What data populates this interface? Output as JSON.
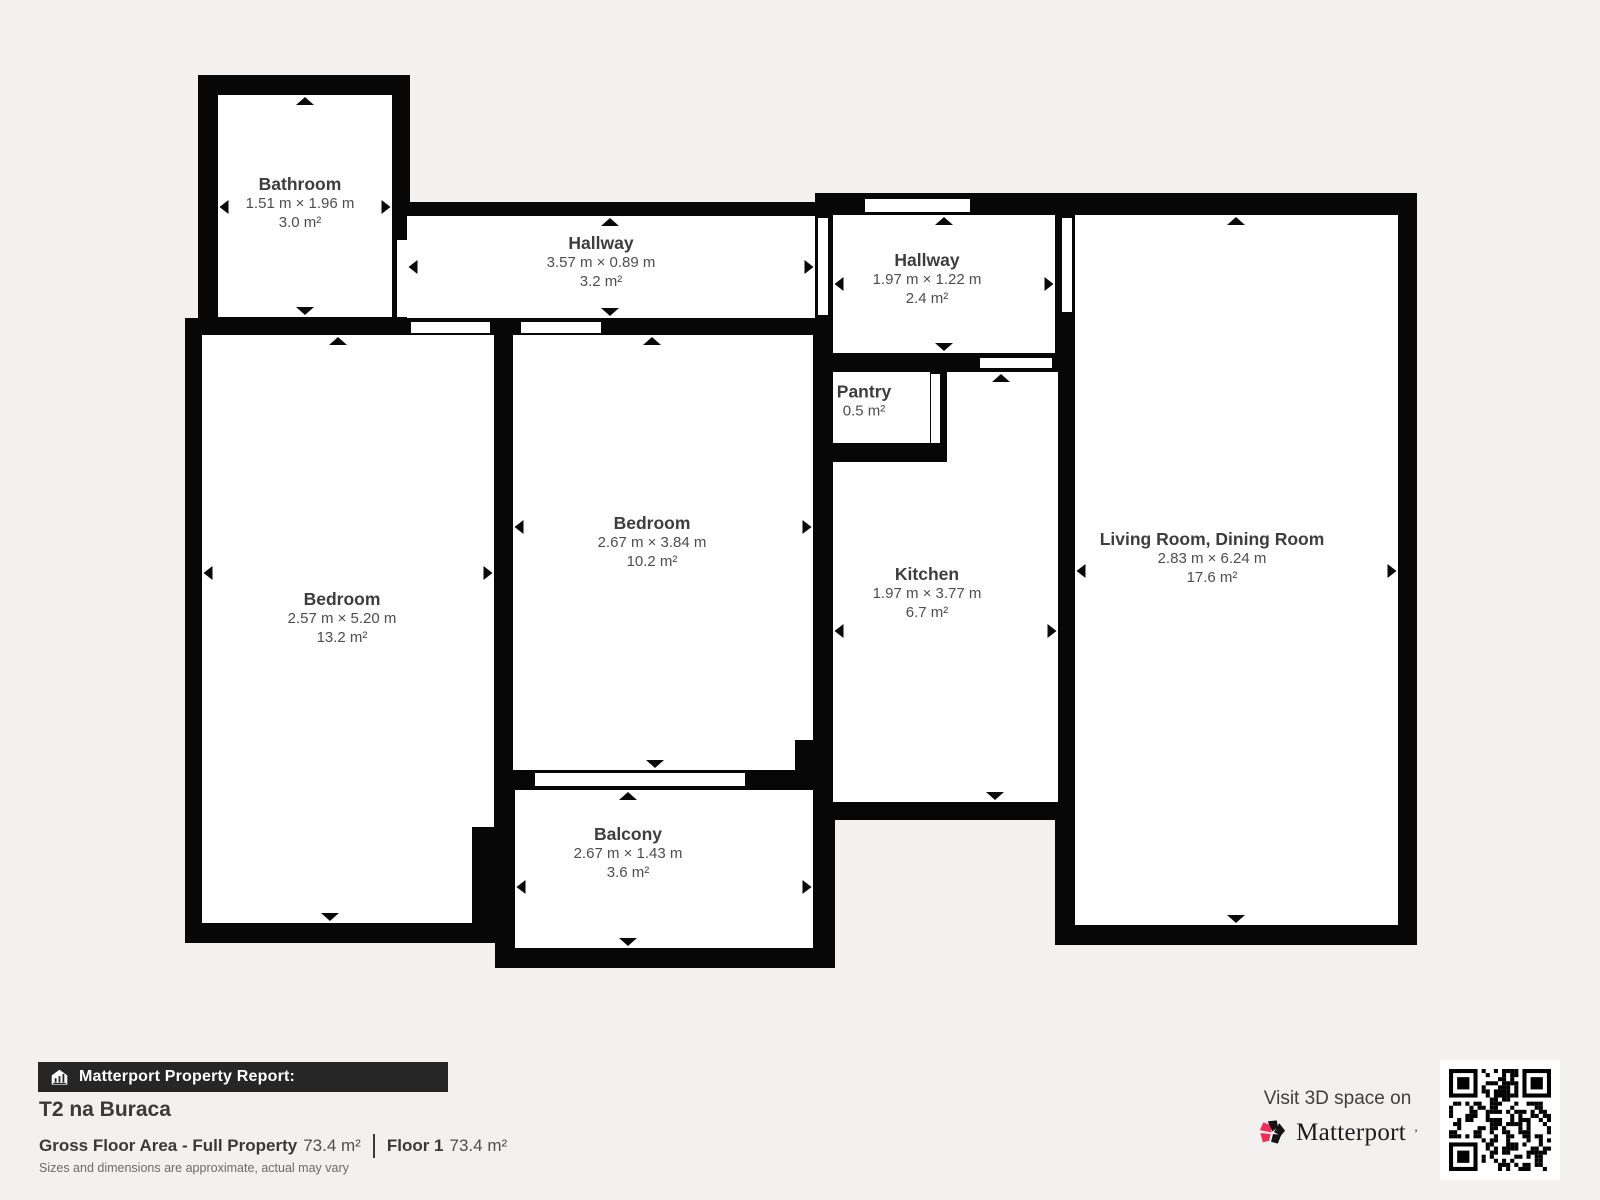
{
  "plan": {
    "rooms": [
      {
        "id": "bathroom",
        "name": "Bathroom",
        "dimensions": "1.51 m × 1.96 m",
        "area": "3.0 m²"
      },
      {
        "id": "hallway-top",
        "name": "Hallway",
        "dimensions": "3.57 m × 0.89 m",
        "area": "3.2 m²"
      },
      {
        "id": "hallway-entry",
        "name": "Hallway",
        "dimensions": "1.97 m × 1.22 m",
        "area": "2.4 m²"
      },
      {
        "id": "pantry",
        "name": "Pantry",
        "dimensions": "",
        "area": "0.5 m²"
      },
      {
        "id": "bedroom-middle",
        "name": "Bedroom",
        "dimensions": "2.67 m × 3.84 m",
        "area": "10.2 m²"
      },
      {
        "id": "bedroom-left",
        "name": "Bedroom",
        "dimensions": "2.57 m × 5.20 m",
        "area": "13.2 m²"
      },
      {
        "id": "kitchen",
        "name": "Kitchen",
        "dimensions": "1.97 m × 3.77 m",
        "area": "6.7 m²"
      },
      {
        "id": "living-room",
        "name": "Living Room, Dining Room",
        "dimensions": "2.83 m × 6.24 m",
        "area": "17.6 m²"
      },
      {
        "id": "balcony",
        "name": "Balcony",
        "dimensions": "2.67 m × 1.43 m",
        "area": "3.6 m²"
      }
    ]
  },
  "report": {
    "bar_label": "Matterport Property Report:",
    "property_name": "T2 na Buraca",
    "gross_label": "Gross Floor Area - Full Property",
    "gross_value": "73.4 m²",
    "floor_label": "Floor 1",
    "floor_value": "73.4 m²",
    "disclaimer": "Sizes and dimensions are approximate, actual may vary"
  },
  "promo": {
    "visit_text": "Visit 3D space on",
    "brand": "Matterport",
    "brand_mark": "’"
  },
  "colors": {
    "background": "#f3f1ef",
    "wall": "#070707",
    "accent_pink": "#ee2e57",
    "bar_background": "#262626"
  }
}
